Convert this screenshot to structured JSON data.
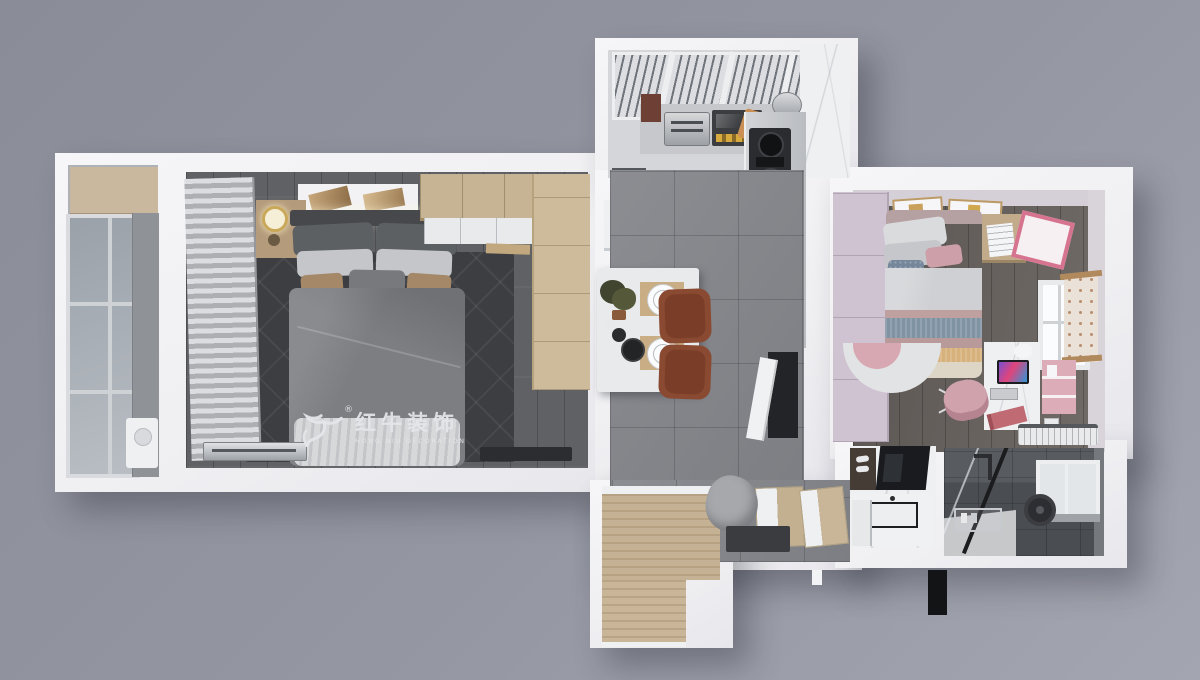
{
  "watermark": {
    "brand_cn": "红牛装饰",
    "brand_en": "HONG NIU DECORATION",
    "registered": "®"
  },
  "palette": {
    "background_top_left": "#8a8c98",
    "background_bottom_right": "#a3a5b0",
    "wall_white": "#f2f2f4",
    "bedroom_floor": "#5f6164",
    "bedroom_rug": "#3c3e41",
    "bed_duvet": "#7c7e82",
    "bed_throw": "#d7d8da",
    "wood_wardrobe": "#c7b494",
    "wood_cabinet": "#c5b294",
    "curtain_gray": "#c6c7ca",
    "tile_floor": "#84868b",
    "dining_chair_brown": "#8a4a32",
    "table_marble": "#e9eaeb",
    "stove_black": "#2a2c2f",
    "kids_wall_lavender": "#d5cfd8",
    "kids_wardrobe_lilac": "#cfc3d1",
    "kids_pink": "#cd9fa9",
    "stripe_blue_gray": "#8093a3",
    "stripe_tan": "#d7b17c",
    "shower_tile_dark": "#4a4d51",
    "watermark_gray": "#e2e4e8"
  }
}
